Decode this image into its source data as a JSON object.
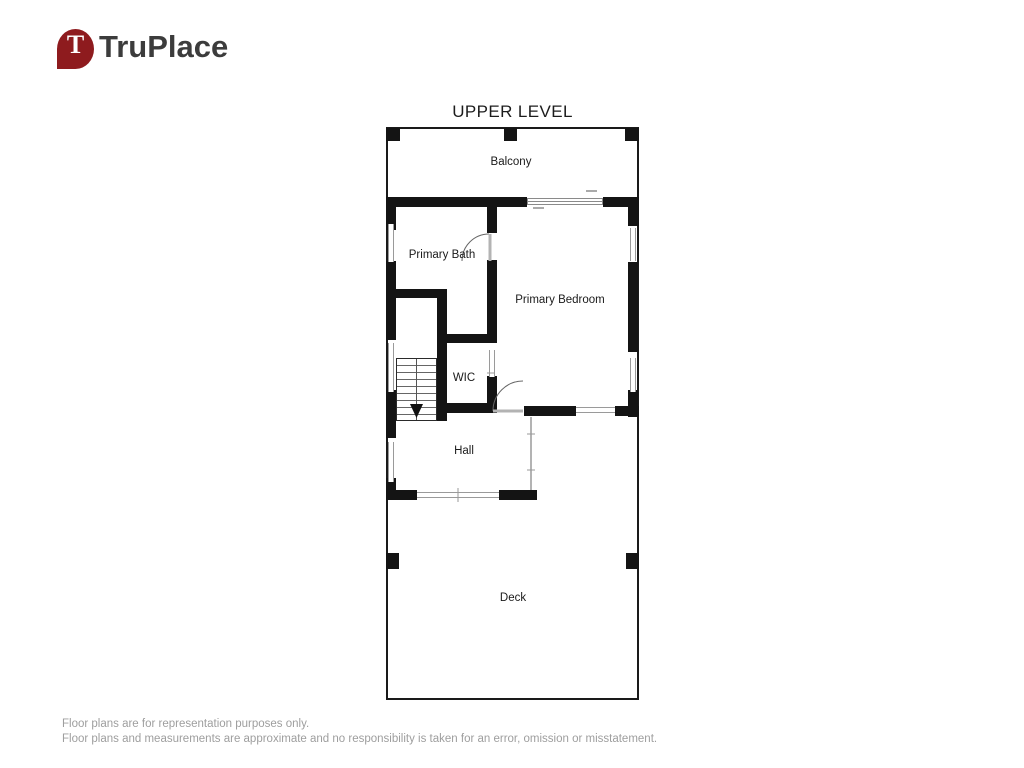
{
  "brand": {
    "name": "TruPlace",
    "pin_letter": "T",
    "pin_color": "#8e1b1e",
    "text_color": "#3c3c3c"
  },
  "floor_plan": {
    "title": "UPPER LEVEL",
    "labels": {
      "balcony": "Balcony",
      "primary_bath": "Primary Bath",
      "primary_bedroom": "Primary Bedroom",
      "wic": "WIC",
      "hall": "Hall",
      "deck": "Deck"
    },
    "stairs": {
      "direction": "down"
    },
    "colors": {
      "wall": "#141414",
      "window": "#9a9a9a",
      "outline": "#1a1a1a"
    }
  },
  "disclaimer": {
    "line1": "Floor plans are for representation purposes only.",
    "line2": "Floor plans and measurements are approximate and no responsibility is taken for an error, omission or misstatement."
  }
}
